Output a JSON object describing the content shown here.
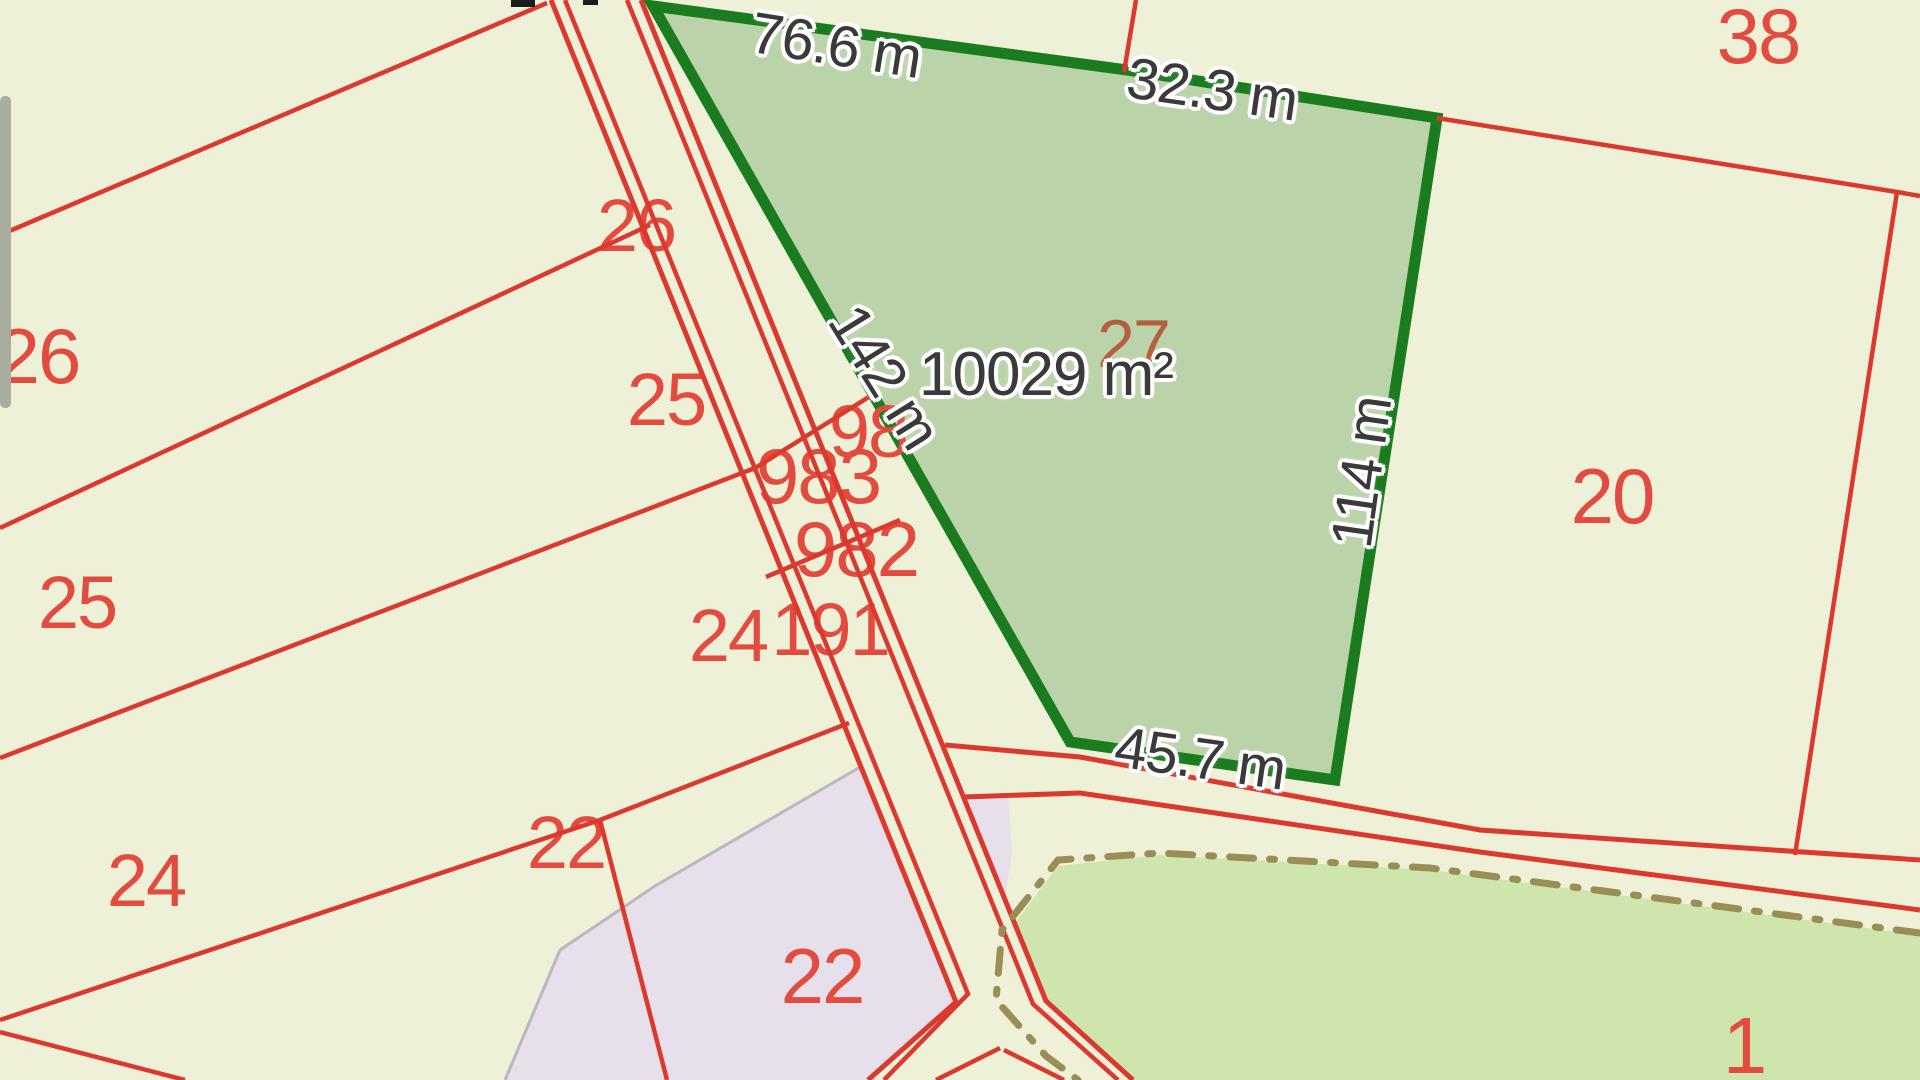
{
  "app": {
    "view": "cadastral-parcel-map"
  },
  "selected_parcel": {
    "number": "27",
    "area": "10029 m²",
    "measurements": {
      "top": "76.6 m",
      "top_right": "32.3 m",
      "right": "114 m",
      "bottom": "45.7 m",
      "left": "142 m"
    }
  },
  "parcel_numbers": {
    "p38": "38",
    "p26_left": "26",
    "p26_road": "26",
    "p25_road": "25",
    "p25_left": "25",
    "p983": "983",
    "p98_fragment": "98",
    "p982": "982",
    "p24_road": "24",
    "p191": "191",
    "p24_left": "24",
    "p22_mid": "22",
    "p22_pink": "22",
    "p20": "20",
    "p1": "1"
  },
  "colors": {
    "background": "#eef0d8",
    "boundary_red": "#dc392e",
    "number_red": "#e24b3d",
    "selected_fill": "#bad3a9",
    "selected_border": "#1b7c1f",
    "selected_number_orange": "#b45f3d",
    "pink_zone": "#e7dfe9",
    "pink_edge_gray": "#bab6c2",
    "parcel1_green": "#cfe5ae",
    "dash_khaki": "#9a8e55",
    "measurement_text": "#3a3a3a",
    "scrollbar_gray": "#a8ad9e"
  }
}
